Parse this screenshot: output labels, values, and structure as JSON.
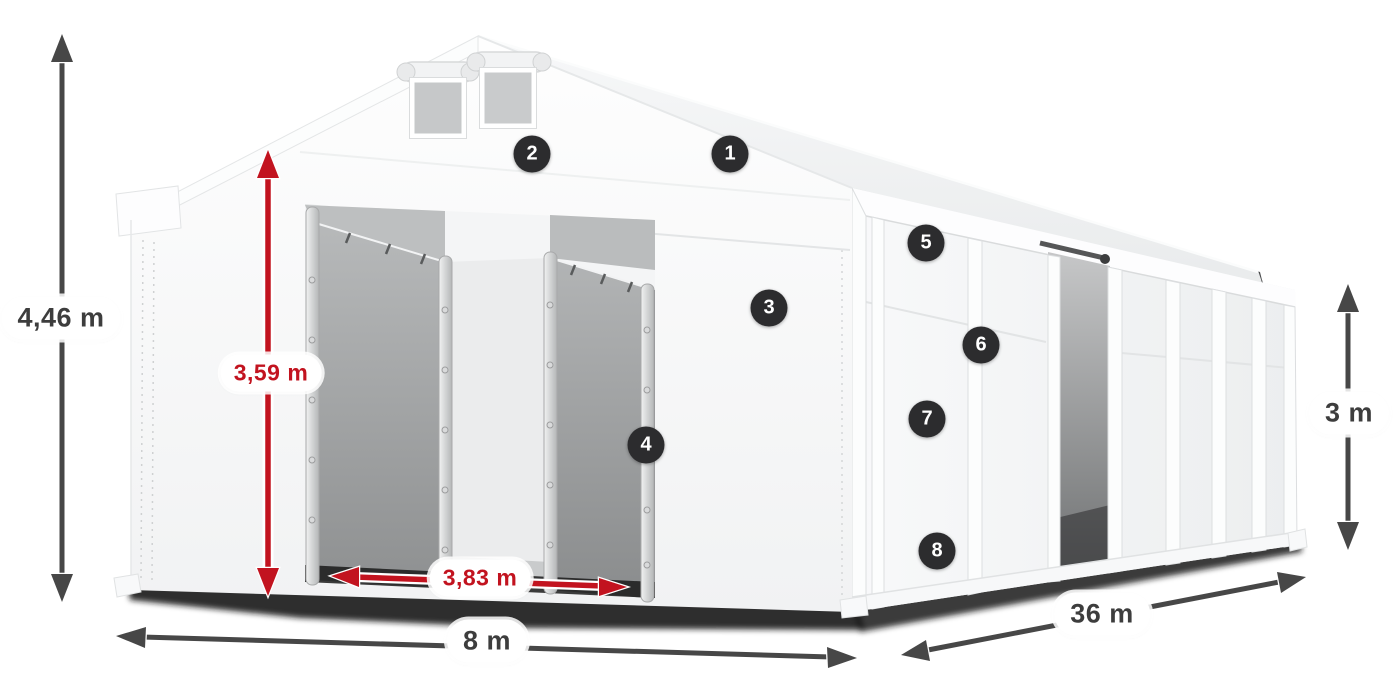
{
  "dimensions": {
    "total_height": {
      "label": "4,46 m",
      "style": "dark",
      "orientation": "vertical"
    },
    "entrance_height": {
      "label": "3,59 m",
      "style": "red",
      "orientation": "vertical"
    },
    "entrance_width": {
      "label": "3,83 m",
      "style": "red",
      "orientation": "horizontal"
    },
    "base_width": {
      "label": "8 m",
      "style": "dark",
      "orientation": "horizontal"
    },
    "length": {
      "label": "36 m",
      "style": "dark",
      "orientation": "diagonal"
    },
    "side_wall_height": {
      "label": "3 m",
      "style": "dark",
      "orientation": "vertical"
    }
  },
  "callouts": {
    "c1": {
      "number": "1"
    },
    "c2": {
      "number": "2"
    },
    "c3": {
      "number": "3"
    },
    "c4": {
      "number": "4"
    },
    "c5": {
      "number": "5"
    },
    "c6": {
      "number": "6"
    },
    "c7": {
      "number": "7"
    },
    "c8": {
      "number": "8"
    }
  },
  "colors": {
    "dimension_dark": "#474747",
    "dimension_red": "#c2131f",
    "badge_background": "#2c2c2e",
    "badge_text": "#ffffff",
    "tent_white": "#f6f7f8",
    "interior_gray": "#a9abac"
  }
}
